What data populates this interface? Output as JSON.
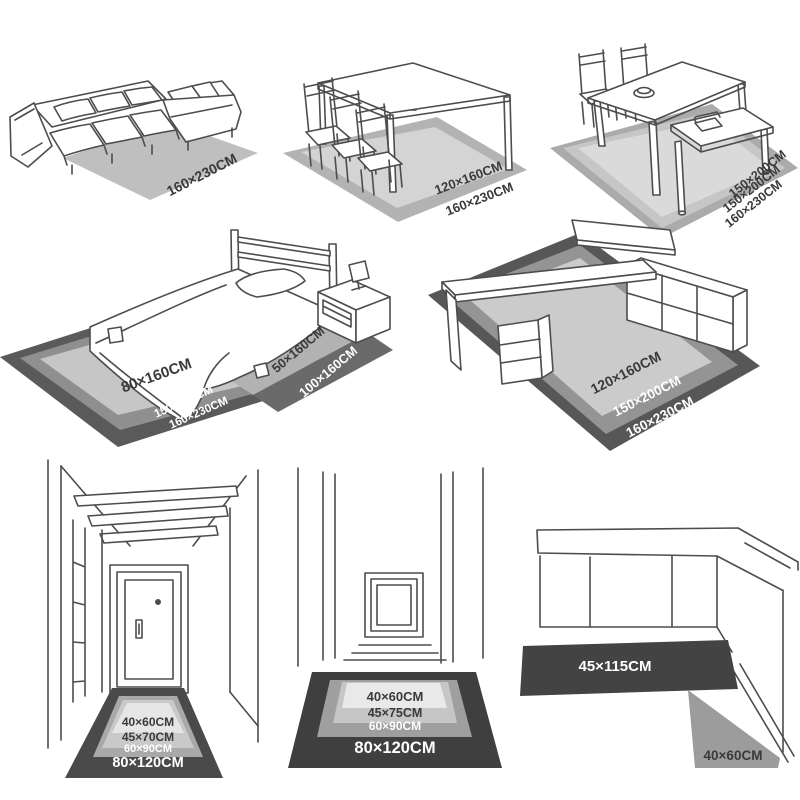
{
  "palette": {
    "line_art": "#4d4d4d",
    "label_dark": "#3a3a3a",
    "label_white": "#ffffff"
  },
  "scenes": {
    "sofa": {
      "rug_fill": "#bfbfbf",
      "labels": [
        "160×230CM"
      ]
    },
    "dining_table": {
      "shades": [
        "#b3b3b3",
        "#d4d4d4"
      ],
      "labels": [
        "120×160CM",
        "160×230CM"
      ]
    },
    "dining_bench": {
      "shades": [
        "#ababab",
        "#c6c6c6",
        "#dadada"
      ],
      "labels": [
        "150×200CM",
        "150×200CM",
        "160×230CM"
      ]
    },
    "bedroom": {
      "shades": [
        "#5a5a5a",
        "#8f8f8f",
        "#c6c6c6"
      ],
      "runner_shades": [
        "#b2b2b2",
        "#6a6a6a"
      ],
      "labels": [
        "80×160CM",
        "150×200CM",
        "160×230CM"
      ],
      "runner_labels": [
        "50×160CM",
        "100×160CM"
      ]
    },
    "desk": {
      "shades": [
        "#575757",
        "#949494",
        "#cbcbcb"
      ],
      "labels": [
        "120×160CM",
        "150×200CM",
        "160×230CM"
      ]
    },
    "hallway": {
      "shades": [
        "#4a4a4a",
        "#a9a9a9",
        "#c9c9c9",
        "#e6e6e6"
      ],
      "labels": [
        "40×60CM",
        "45×70CM",
        "60×90CM",
        "80×120CM"
      ]
    },
    "corridor": {
      "shades": [
        "#3f3f3f",
        "#9f9f9f",
        "#c6c6c6",
        "#e9e9e9"
      ],
      "labels": [
        "40×60CM",
        "45×75CM",
        "60×90CM",
        "80×120CM"
      ]
    },
    "kitchen": {
      "runner_fill": "#434343",
      "mat_fill": "#9c9c9c",
      "labels": [
        "45×115CM",
        "40×60CM"
      ]
    }
  }
}
